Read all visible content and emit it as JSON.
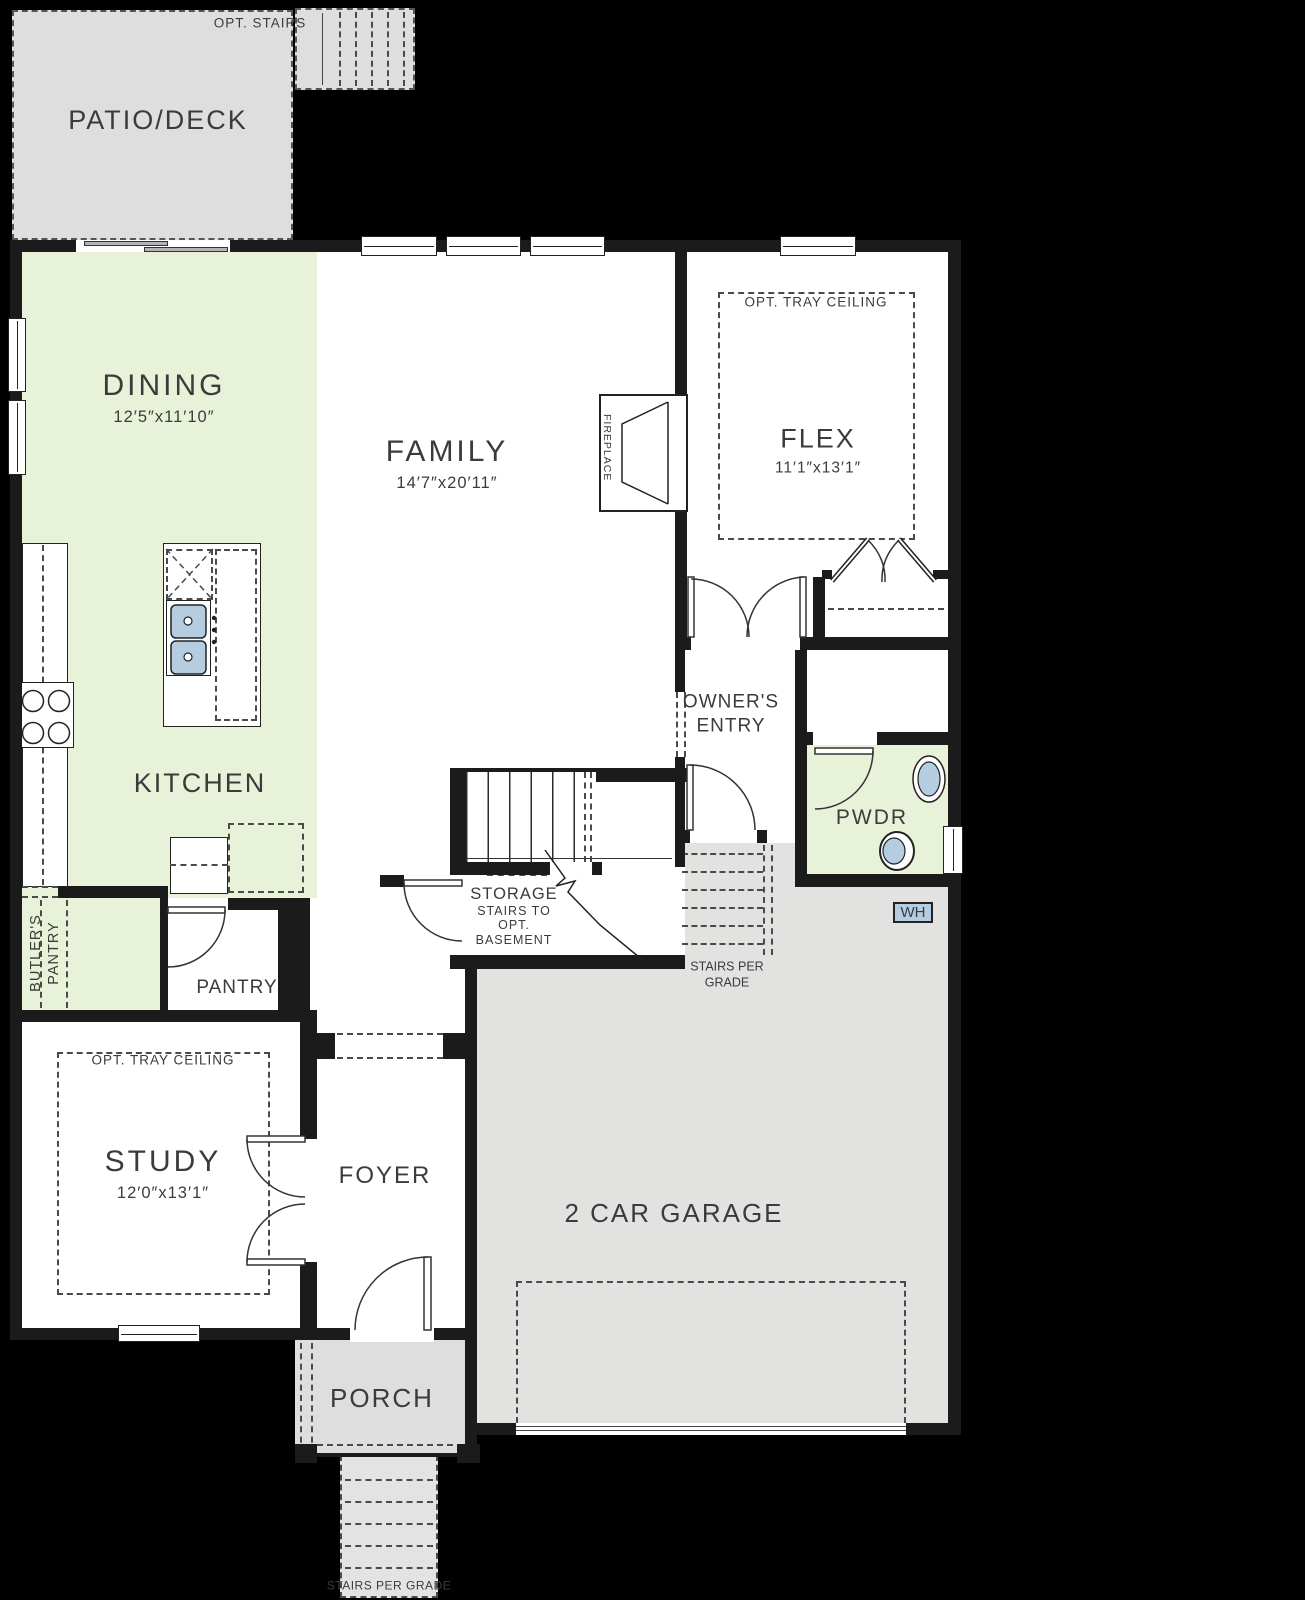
{
  "colors": {
    "background": "#000000",
    "wall": "#1b1b1b",
    "floor_white": "#ffffff",
    "floor_green": "#e8f2d8",
    "garage_gray": "#e2e2e1",
    "patio_gray": "#dedede",
    "fixture_blue": "#b5cde0",
    "text": "#3b3b3b"
  },
  "rooms": {
    "patio": {
      "label": "PATIO/DECK"
    },
    "opt_stairs": {
      "label": "OPT. STAIRS"
    },
    "dining": {
      "label": "DINING",
      "dims": "12′5″x11′10″"
    },
    "family": {
      "label": "FAMILY",
      "dims": "14′7″x20′11″"
    },
    "flex": {
      "label": "FLEX",
      "dims": "11′1″x13′1″",
      "note": "OPT. TRAY CEILING"
    },
    "kitchen": {
      "label": "KITCHEN"
    },
    "butlers_pantry": {
      "line1": "BUTLER'S",
      "line2": "PANTRY"
    },
    "pantry": {
      "label": "PANTRY"
    },
    "owners_entry": {
      "line1": "OWNER'S",
      "line2": "ENTRY"
    },
    "pwdr": {
      "label": "PWDR"
    },
    "storage": {
      "label": "STORAGE",
      "note1": "STAIRS TO",
      "note2": "OPT.",
      "note3": "BASEMENT"
    },
    "garage_stairs": {
      "line1": "STAIRS PER",
      "line2": "GRADE"
    },
    "study": {
      "label": "STUDY",
      "dims": "12′0″x13′1″",
      "note": "OPT. TRAY CEILING"
    },
    "foyer": {
      "label": "FOYER"
    },
    "garage": {
      "label": "2 CAR GARAGE"
    },
    "porch": {
      "label": "PORCH"
    },
    "front_stairs": {
      "label": "STAIRS PER GRADE"
    },
    "fireplace": {
      "label": "FIREPLACE"
    },
    "water_heater": {
      "label": "WH"
    }
  }
}
